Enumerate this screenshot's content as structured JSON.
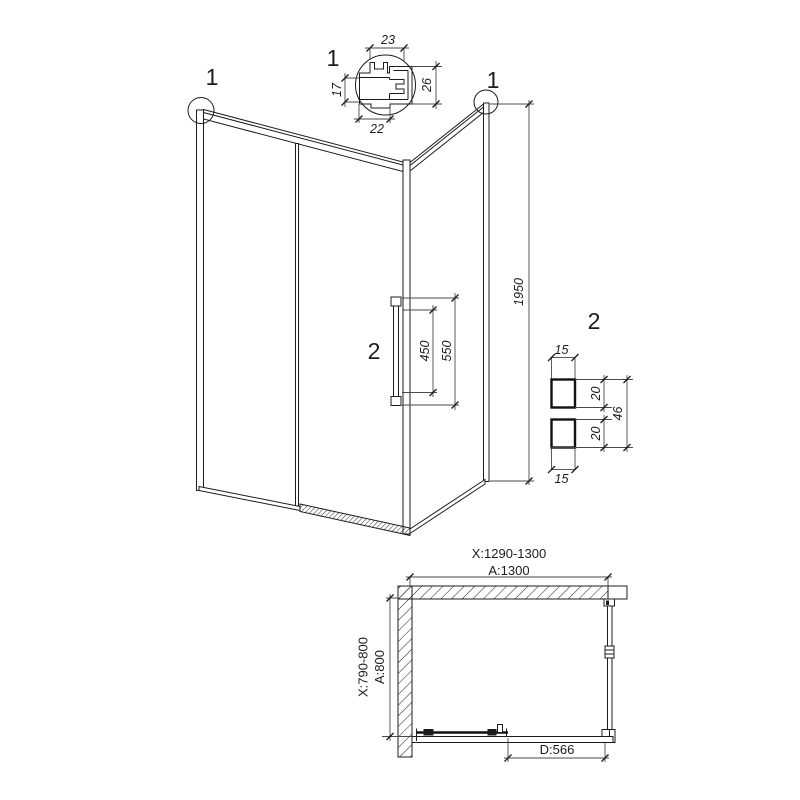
{
  "fig": {
    "background": "#ffffff",
    "line_color": "#1c1c1c",
    "detail1": {
      "callout": "1",
      "dim_top": "23",
      "dim_left": "17",
      "dim_right": "26",
      "dim_bottom": "22"
    },
    "elevation": {
      "callout_left": "1",
      "callout_right": "1",
      "door_callout": "2",
      "dim_height": "1950",
      "dim_handle_inner": "450",
      "dim_handle_outer": "550"
    },
    "detail2": {
      "callout": "2",
      "dim_top_width": "15",
      "dim_upper_height": "20",
      "dim_total_height": "46",
      "dim_lower_height": "20",
      "dim_bottom_width": "15"
    },
    "plan": {
      "dim_width_range": "X:1290-1300",
      "dim_width_nominal": "A:1300",
      "dim_depth_range": "X:790-800",
      "dim_depth_nominal": "A:800",
      "dim_door_width": "D:566"
    }
  }
}
